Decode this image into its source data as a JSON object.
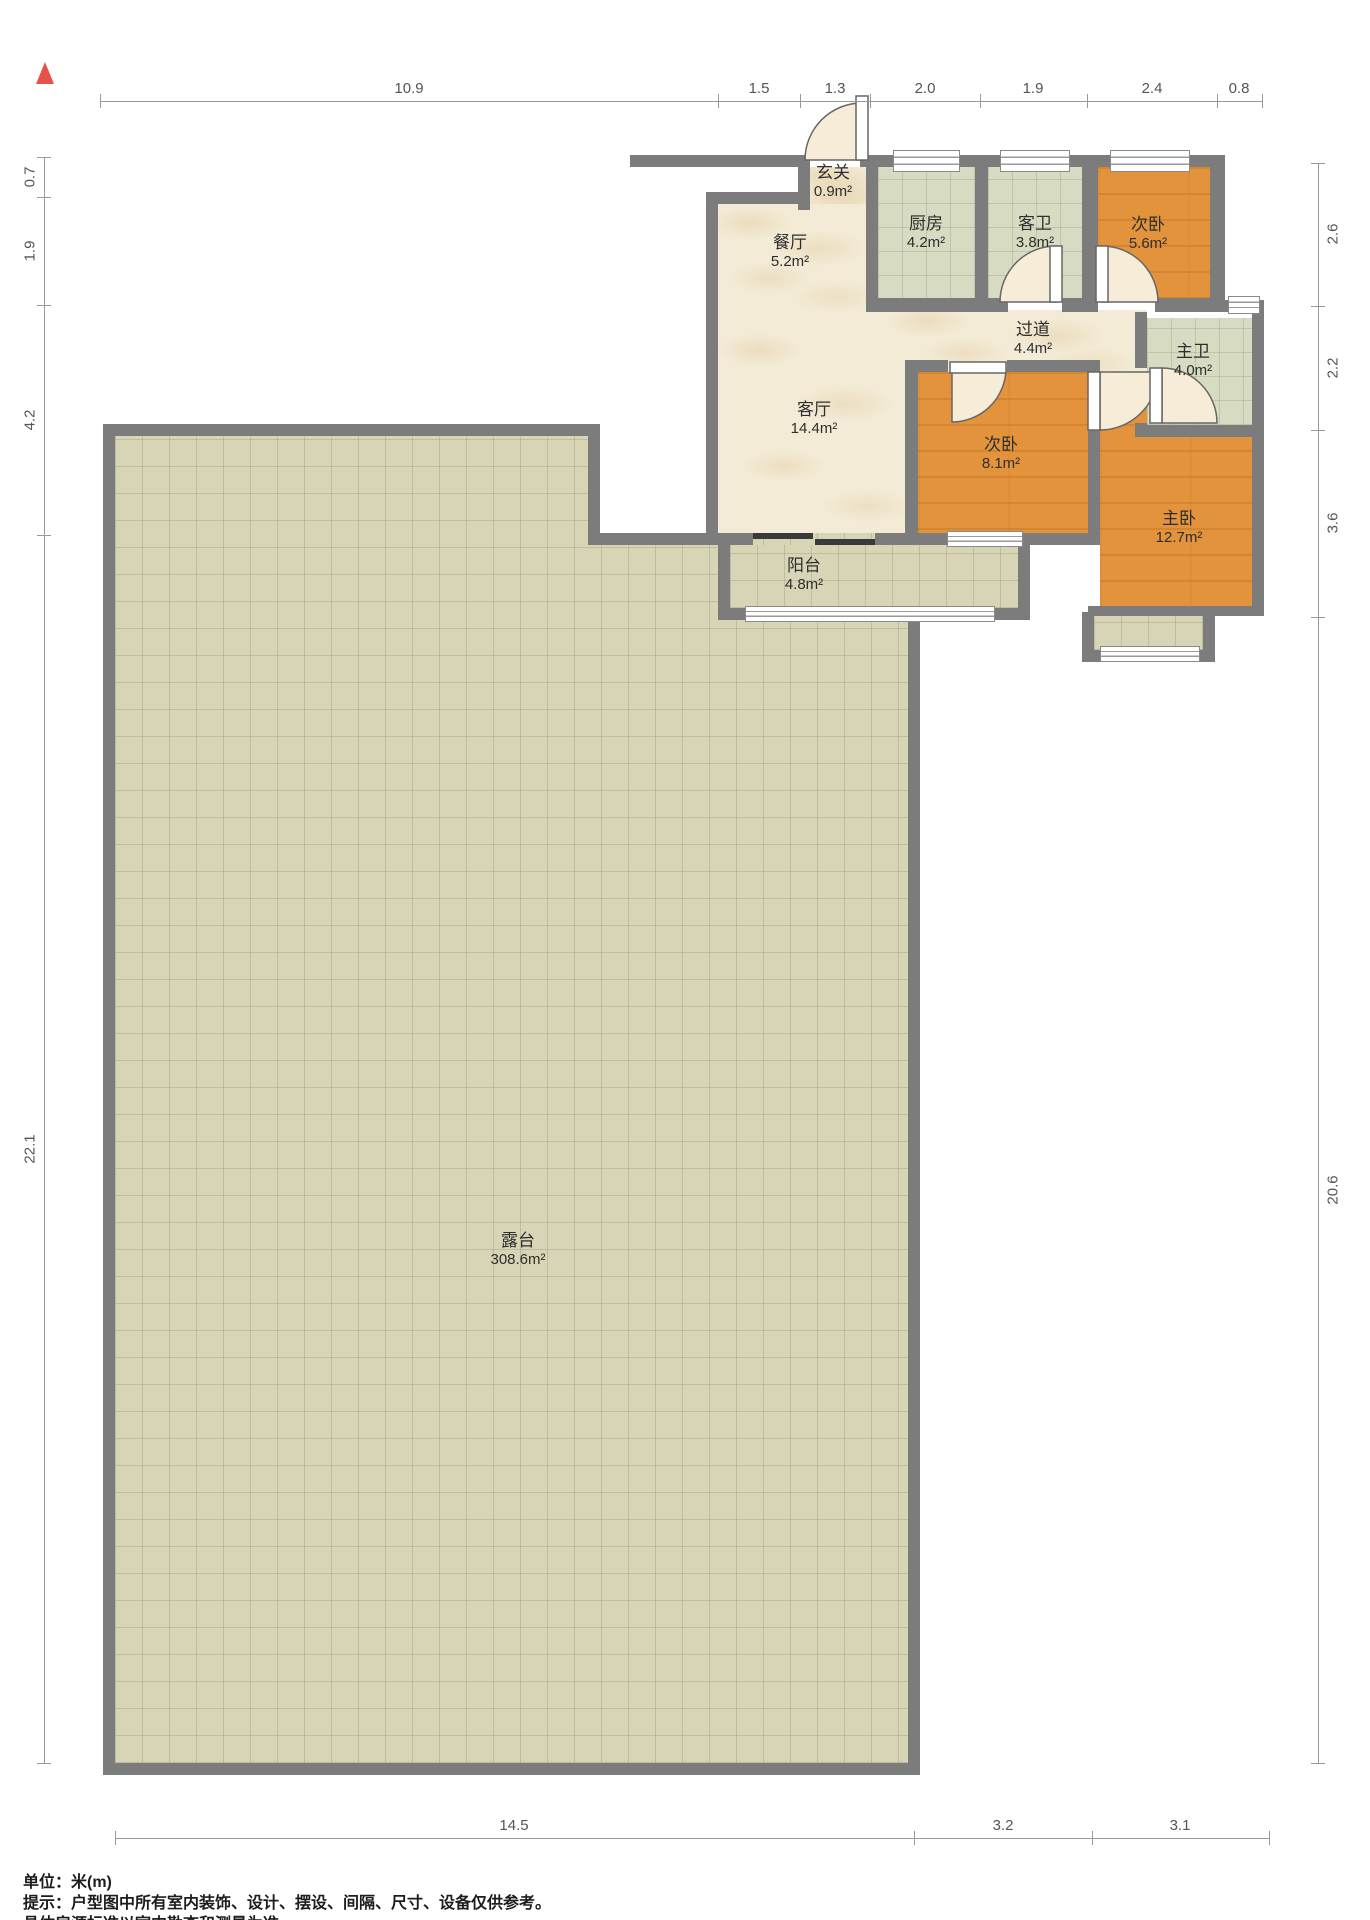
{
  "north_indicator": "north-arrow",
  "rooms": [
    {
      "name": "玄关",
      "area": "0.9m²"
    },
    {
      "name": "餐厅",
      "area": "5.2m²"
    },
    {
      "name": "厨房",
      "area": "4.2m²"
    },
    {
      "name": "客卫",
      "area": "3.8m²"
    },
    {
      "name": "次卧",
      "area": "5.6m²"
    },
    {
      "name": "过道",
      "area": "4.4m²"
    },
    {
      "name": "主卫",
      "area": "4.0m²"
    },
    {
      "name": "客厅",
      "area": "14.4m²"
    },
    {
      "name": "次卧",
      "area": "8.1m²"
    },
    {
      "name": "主卧",
      "area": "12.7m²"
    },
    {
      "name": "阳台",
      "area": "4.8m²"
    },
    {
      "name": "露台",
      "area": "308.6m²"
    }
  ],
  "dimensions": {
    "top": [
      "10.9",
      "1.5",
      "1.3",
      "2.0",
      "1.9",
      "2.4",
      "0.8"
    ],
    "left": [
      "0.7",
      "1.9",
      "4.2",
      "22.1"
    ],
    "right": [
      "2.6",
      "2.2",
      "3.6",
      "20.6"
    ],
    "bottom": [
      "14.5",
      "3.2",
      "3.1"
    ]
  },
  "footer": {
    "line1": "单位：米(m)",
    "line2": "提示：户型图中所有室内装饰、设计、摆设、间隔、尺寸、设备仅供参考。",
    "line3": "具体房源标准以室内勘查和测量为准。"
  },
  "colors": {
    "wall": "#7c7c7c",
    "marble_floor": "#f3ebd6",
    "tile_floor": "#d7dbc1",
    "wood_floor": "#e2933b",
    "terrace_floor": "#d8d4b6",
    "north_arrow": "#e8514a",
    "dimension_text": "#555555"
  }
}
